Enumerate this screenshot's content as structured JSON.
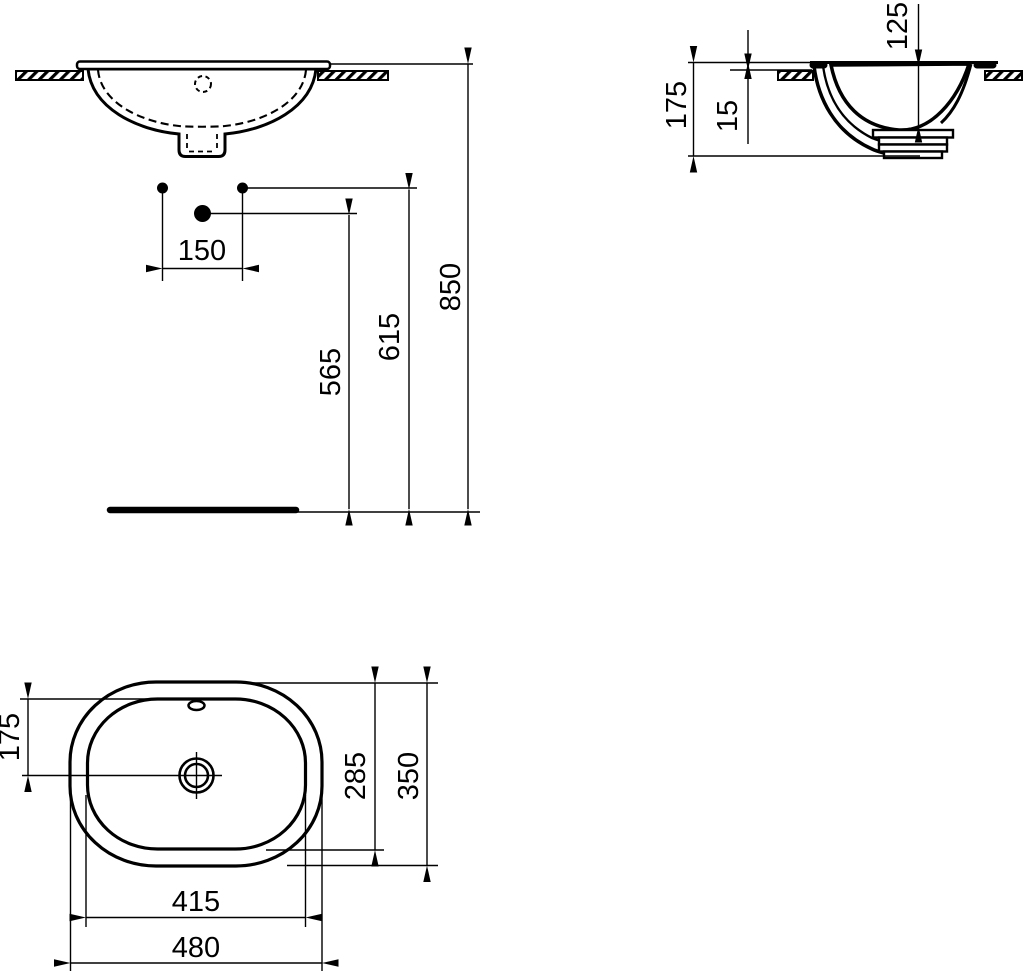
{
  "meta": {
    "type": "technical-dimension-drawing",
    "subject": "Oval countertop washbasin - three view installation drawing",
    "unit": "mm"
  },
  "front_view": {
    "tap_hole_spacing": "150",
    "waste_outlet_height": "565",
    "supply_connection_height": "615",
    "worktop_height": "850"
  },
  "side_view": {
    "basin_total_height": "175",
    "rim_above_worktop": "15",
    "bowl_depth": "125"
  },
  "plan_view": {
    "drain_center_from_rear": "175",
    "inner_bowl_width": "285",
    "overall_width": "350",
    "inner_bowl_length": "415",
    "overall_length": "480"
  }
}
